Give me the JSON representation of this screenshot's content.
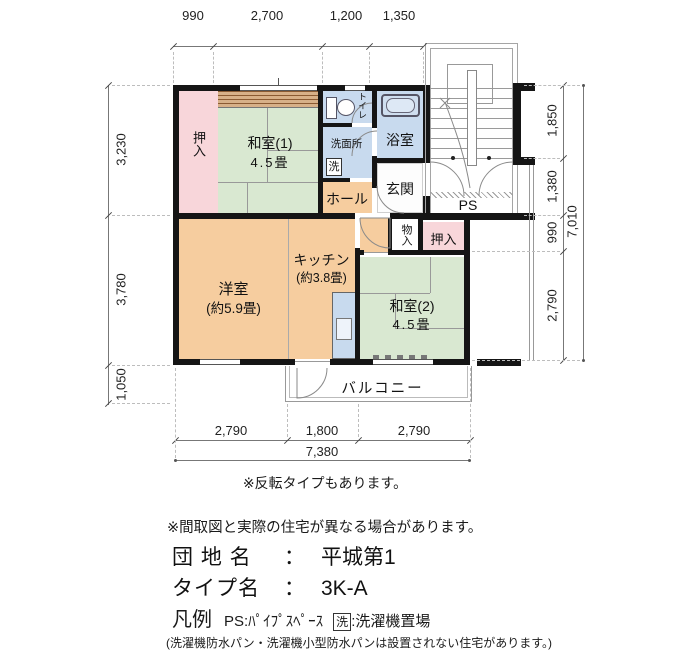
{
  "plan": {
    "rooms": {
      "oshiire1": {
        "label": "押入"
      },
      "washitsu1": {
        "label": "和室(1)",
        "size": "4.5畳"
      },
      "toilet": {
        "label": "トイレ"
      },
      "senmenjo": {
        "label": "洗面所",
        "washer": "洗"
      },
      "bathroom": {
        "label": "浴室"
      },
      "genkan": {
        "label": "玄関"
      },
      "hall": {
        "label": "ホール"
      },
      "monoire": {
        "label": "物入"
      },
      "oshiire2": {
        "label": "押入"
      },
      "yoshitsu": {
        "label": "洋室",
        "size": "(約5.9畳)"
      },
      "kitchen": {
        "label": "キッチン",
        "size": "(約3.8畳)"
      },
      "washitsu2": {
        "label": "和室(2)",
        "size": "4.5畳"
      },
      "balcony": {
        "label": "バルコニー"
      },
      "ps": {
        "label": "PS"
      }
    },
    "dimensions": {
      "top": [
        "990",
        "2,700",
        "1,200",
        "1,350"
      ],
      "left": [
        "3,230",
        "3,780",
        "1,050"
      ],
      "right": [
        "1,850",
        "1,380",
        "990",
        "2,790"
      ],
      "right_total": "7,010",
      "bottom": [
        "2,790",
        "1,800",
        "2,790"
      ],
      "bottom_total": "7,380"
    },
    "note_flip": "※反転タイプもあります。"
  },
  "footer": {
    "note": "※間取図と実際の住宅が異なる場合があります。",
    "colon": "：",
    "estate": {
      "label": "団 地 名",
      "value": "平城第1"
    },
    "type": {
      "label": "タイプ名",
      "value": "3K-A"
    },
    "legend": {
      "title": "凡例",
      "ps": "PS:ﾊﾟｲﾌﾟｽﾍﾟｰｽ",
      "washer": "洗",
      "washer_desc": ":洗濯機置場"
    },
    "fine_print": "(洗濯機防水パン・洗濯機小型防水パンは設置されない住宅があります。)"
  },
  "colors": {
    "tatami_green": "#d9e8d1",
    "flooring_orange": "#f6cd9f",
    "closet_pink": "#f8d6da",
    "water_blue": "#c8daee",
    "wood_strip": "#d7b088",
    "wall": "#151515"
  }
}
